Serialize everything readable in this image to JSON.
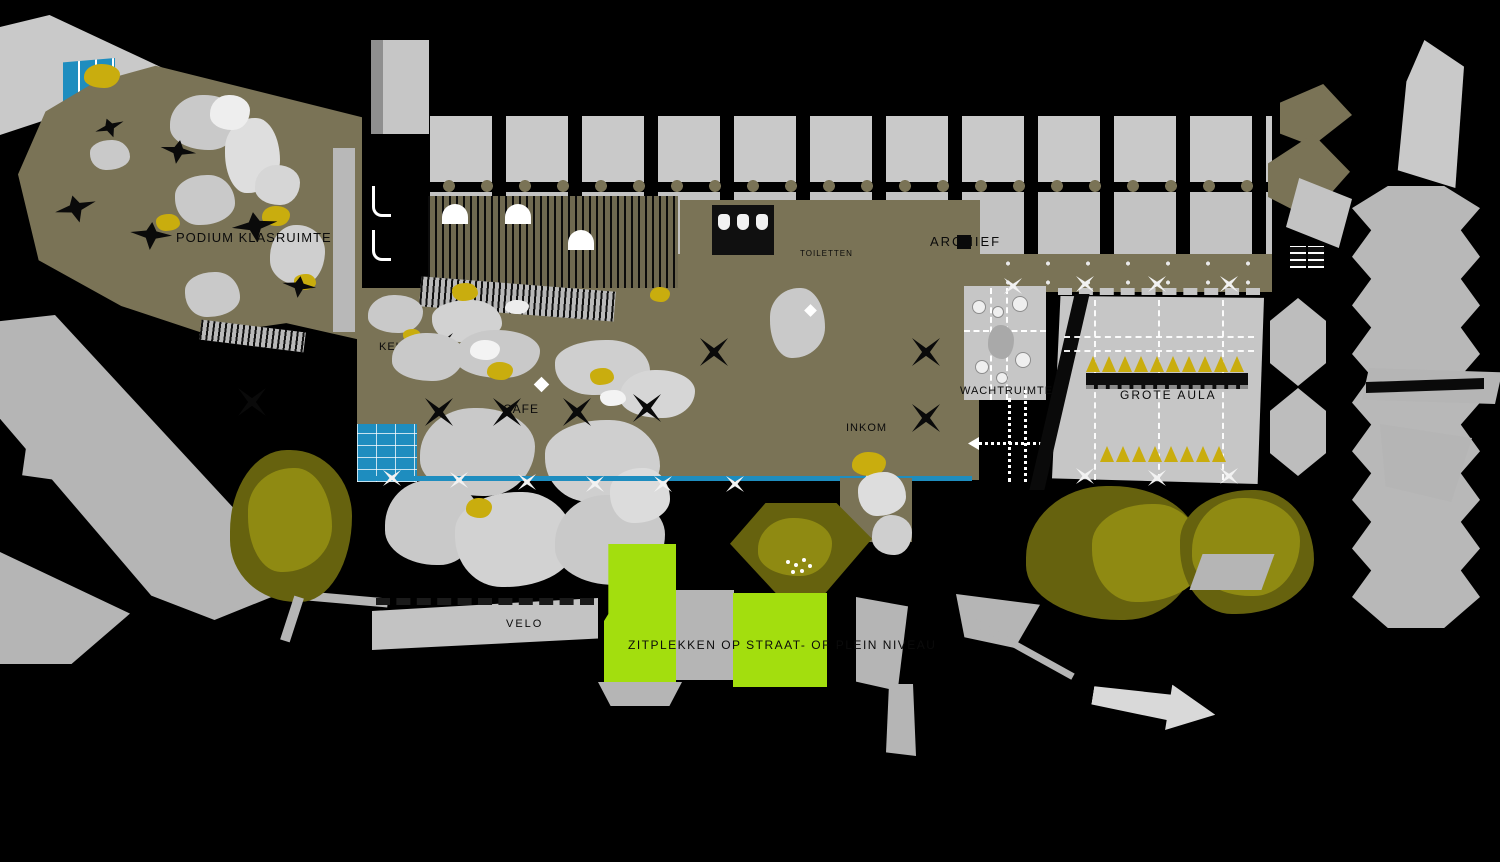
{
  "labels": {
    "podium": "PODIUM KLASRUIMTE",
    "archief": "ARCHIEF",
    "toiletten": "TOILETTEN",
    "keuken": "KEUKEN",
    "cafe": "CAFE",
    "wachtruimte": "WACHTRUIMTE",
    "grote_aula": "GROTE AULA",
    "inkom": "INKOM",
    "rechts_fragment": "EL",
    "velo": "VELO",
    "zitplekken": "ZITPLEKKEN OP STRAAT- OF PLEIN NIVEAU"
  },
  "colors": {
    "background": "#000000",
    "floor_olive": "#7a7356",
    "light_gray": "#c9c9c9",
    "mid_gray": "#b5b5b5",
    "accent_yellow": "#c9ad0e",
    "bright_green": "#a3de0e",
    "tree_dark_olive": "#66620e",
    "tree_light_olive": "#8f8a12",
    "water_blue": "#1e8dbf"
  }
}
